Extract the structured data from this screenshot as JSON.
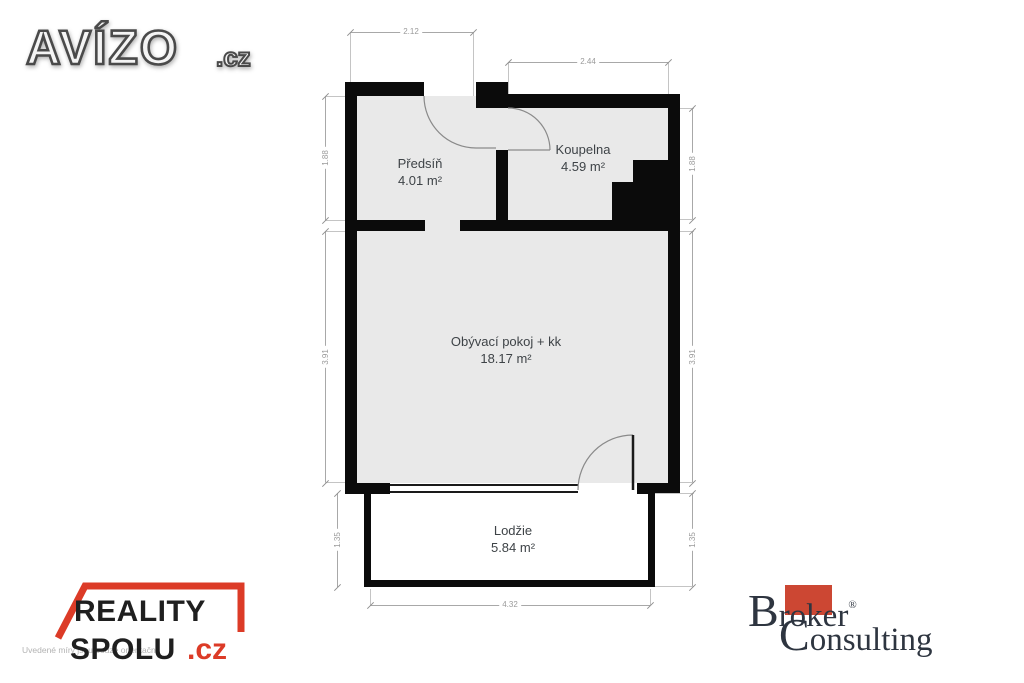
{
  "logos": {
    "avizo": {
      "name": "AVÍZO",
      "tld": ".cz"
    },
    "reality": {
      "word1": "REALITY",
      "word2": "SPOLU",
      "tld": ".cz",
      "roof_red": "#dc3b27"
    },
    "broker": {
      "initial1": "B",
      "rest1": "roker",
      "reg": "®",
      "initial2": "C",
      "rest2": "onsulting",
      "square_red": "#cc4733",
      "text_color": "#2e3540"
    },
    "disclaimer": "Uvedené míry jsou pouze orientační"
  },
  "plan": {
    "rooms": {
      "predsin": {
        "name": "Předsíň",
        "area": "4.01 m²"
      },
      "koupelna": {
        "name": "Koupelna",
        "area": "4.59 m²"
      },
      "obyvaci": {
        "name": "Obývací pokoj + kk",
        "area": "18.17 m²"
      },
      "lodzie": {
        "name": "Lodžie",
        "area": "5.84 m²"
      }
    },
    "dims": {
      "top_left": "2.12",
      "top_right": "2.44",
      "upper_left": "1.88",
      "upper_right": "1.88",
      "mid_left": "3.91",
      "mid_right": "3.91",
      "lower_left": "1.35",
      "lower_right": "1.35",
      "bottom": "4.32"
    },
    "colors": {
      "wall": "#0b0b0b",
      "floor": "#e9e9e9",
      "dim_line": "#a8a8a8",
      "label": "#3e4347"
    }
  }
}
